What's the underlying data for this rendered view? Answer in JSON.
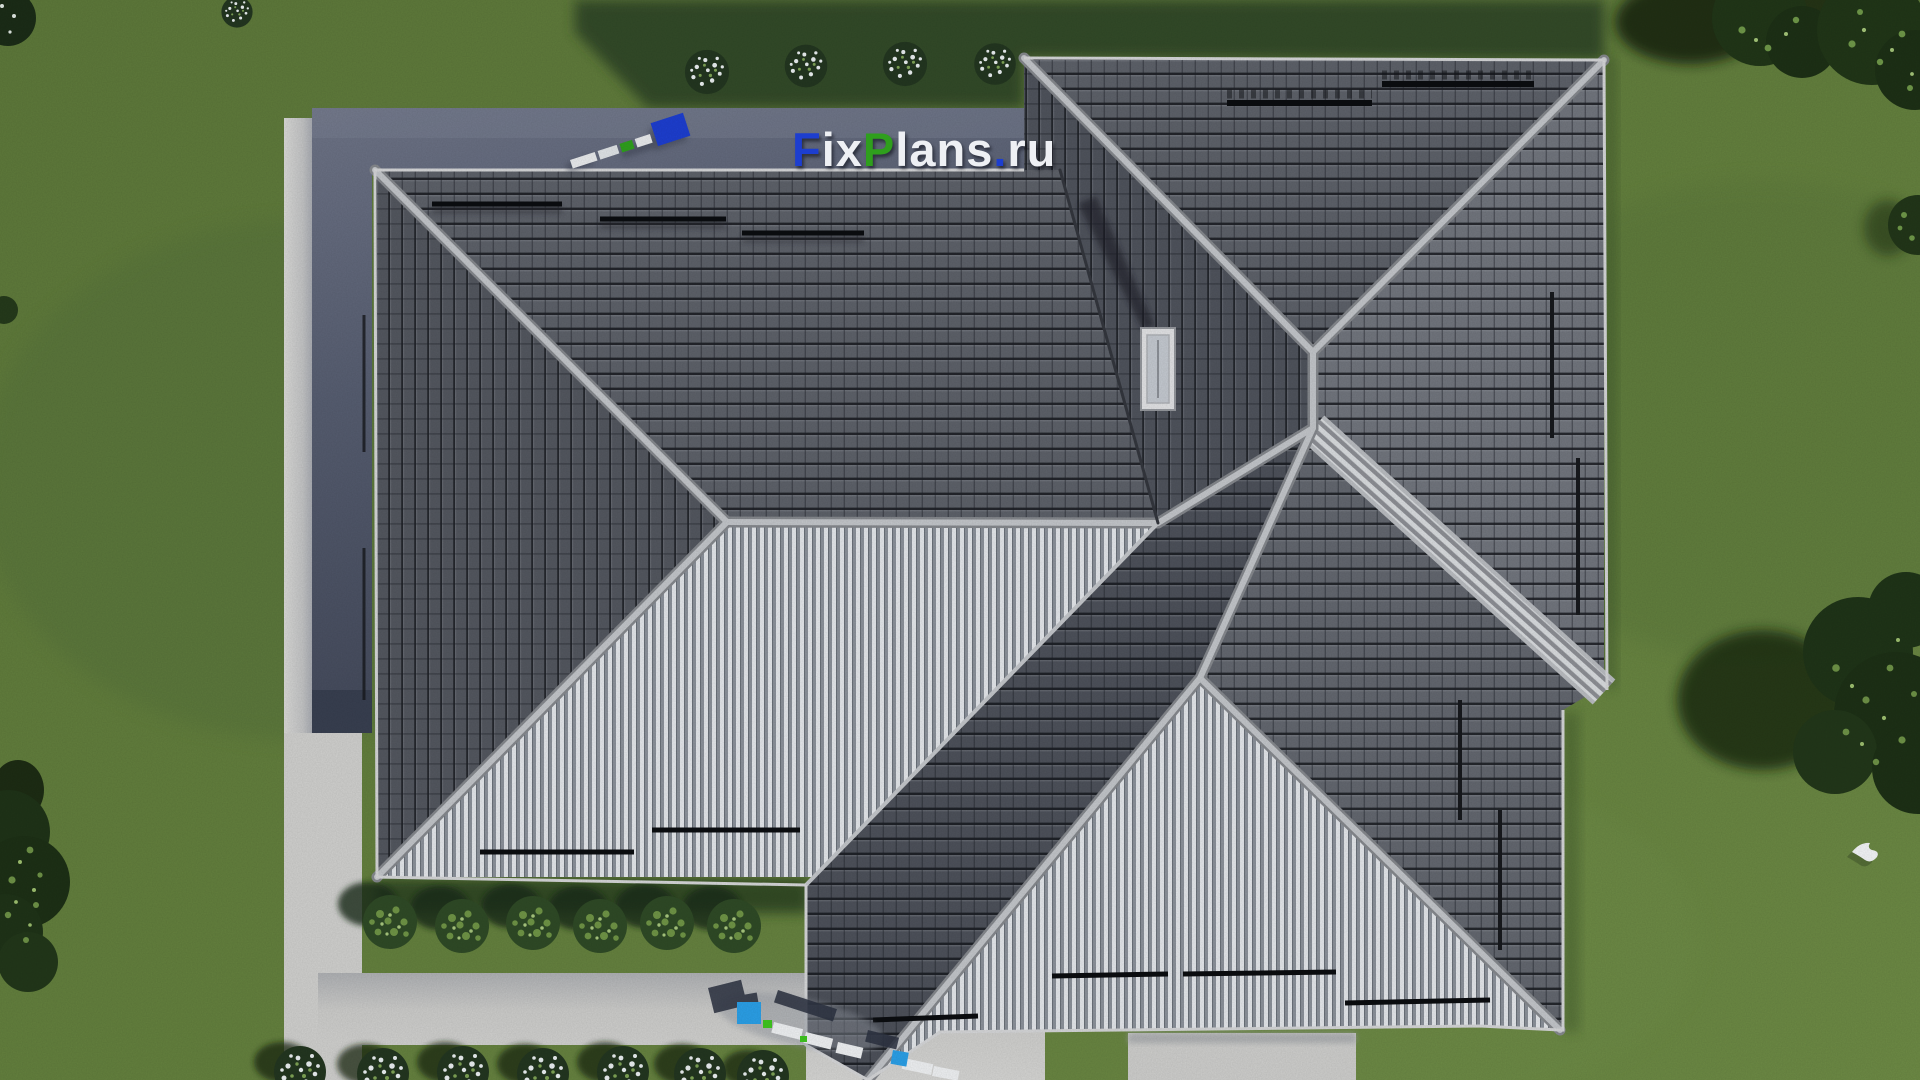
{
  "watermark": {
    "full_text": "FixPlans.ru",
    "part_f": "F",
    "part_ix": "ix",
    "part_p": "P",
    "part_lans": "lans",
    "part_dot": ".",
    "part_ru": "ru",
    "brand_blue": "#1d3ecf",
    "brand_green": "#2f9f1d",
    "brand_light": "#eef0f4"
  },
  "palette": {
    "lawn": "#617d3d",
    "lawn_shadow": "#2e4426",
    "roof_dark_tiles": "#565a63",
    "roof_light_slope": "#e3e6ea",
    "ridge_caps": "#b6b9be",
    "silver_valley": "#d8dbde",
    "terrace_paving": "#5a6175",
    "concrete_path": "#c9c9c7",
    "chimney": "#e0e1e3",
    "accent_blue_3d": "#2b9fe6",
    "accent_green_3d": "#3fc520"
  }
}
